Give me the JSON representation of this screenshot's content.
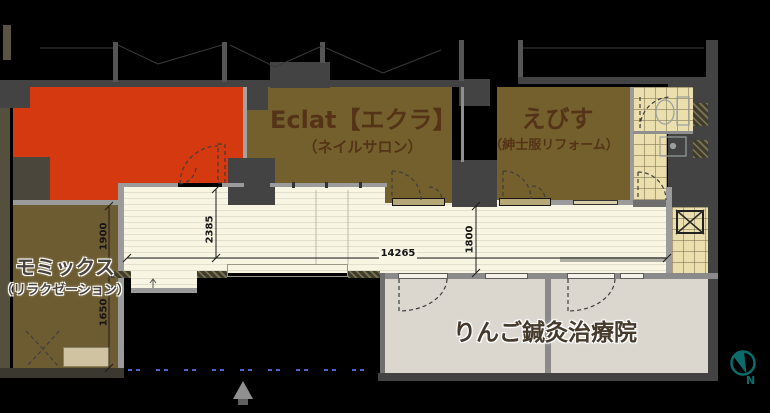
{
  "units": {
    "vacant": {
      "color": "#d4390f"
    },
    "eclat": {
      "name": "Eclat【エクラ】",
      "category": "（ネイルサロン）"
    },
    "ebisu": {
      "name": "えびす",
      "category": "（紳士服リフォーム）"
    },
    "momix": {
      "name": "モミックス",
      "category": "（リラクゼーション）"
    },
    "ringo": {
      "name": "りんご鍼灸治療院"
    }
  },
  "dimensions_mm": {
    "momix_upper": "1900",
    "momix_lower": "1650",
    "entrance_depth": "2385",
    "corridor_length": "14265",
    "corridor_width": "1800"
  },
  "compass": {
    "north_label": "N",
    "color": "#0c6c6c"
  },
  "colors": {
    "vacant_red": "#d4390f",
    "tenant_olive": "#74602c",
    "corridor_cream": "#f8f5e3",
    "wall_gray": "#434343",
    "boundary_blue": "#4a63c8"
  }
}
